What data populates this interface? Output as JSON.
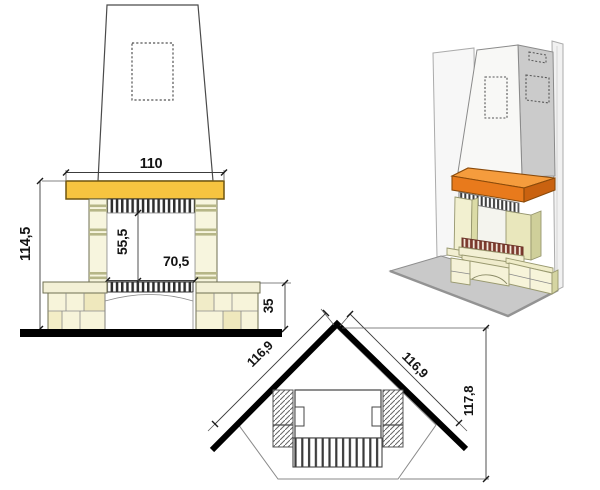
{
  "diagram": {
    "front_elevation": {
      "dim_mantel_width": "110",
      "dim_total_height": "114,5",
      "dim_firebox_height": "55,5",
      "dim_firebox_width": "70,5",
      "dim_base_height": "35"
    },
    "plan_view": {
      "dim_left_wall": "116,9",
      "dim_right_wall": "116,9",
      "dim_total_depth": "117,8"
    },
    "colors": {
      "mantel_yellow": "#F6C440",
      "mantel_orange_front": "#E87A1C",
      "mantel_orange_top": "#F59C3D",
      "mantel_orange_side": "#C96210",
      "stone_cream": "#F5F2D8",
      "stone_olive": "#DBDBA6",
      "floor_gray": "#C9C9C9",
      "grate_red": "#7C3A2E",
      "wall_black": "#000000"
    }
  }
}
